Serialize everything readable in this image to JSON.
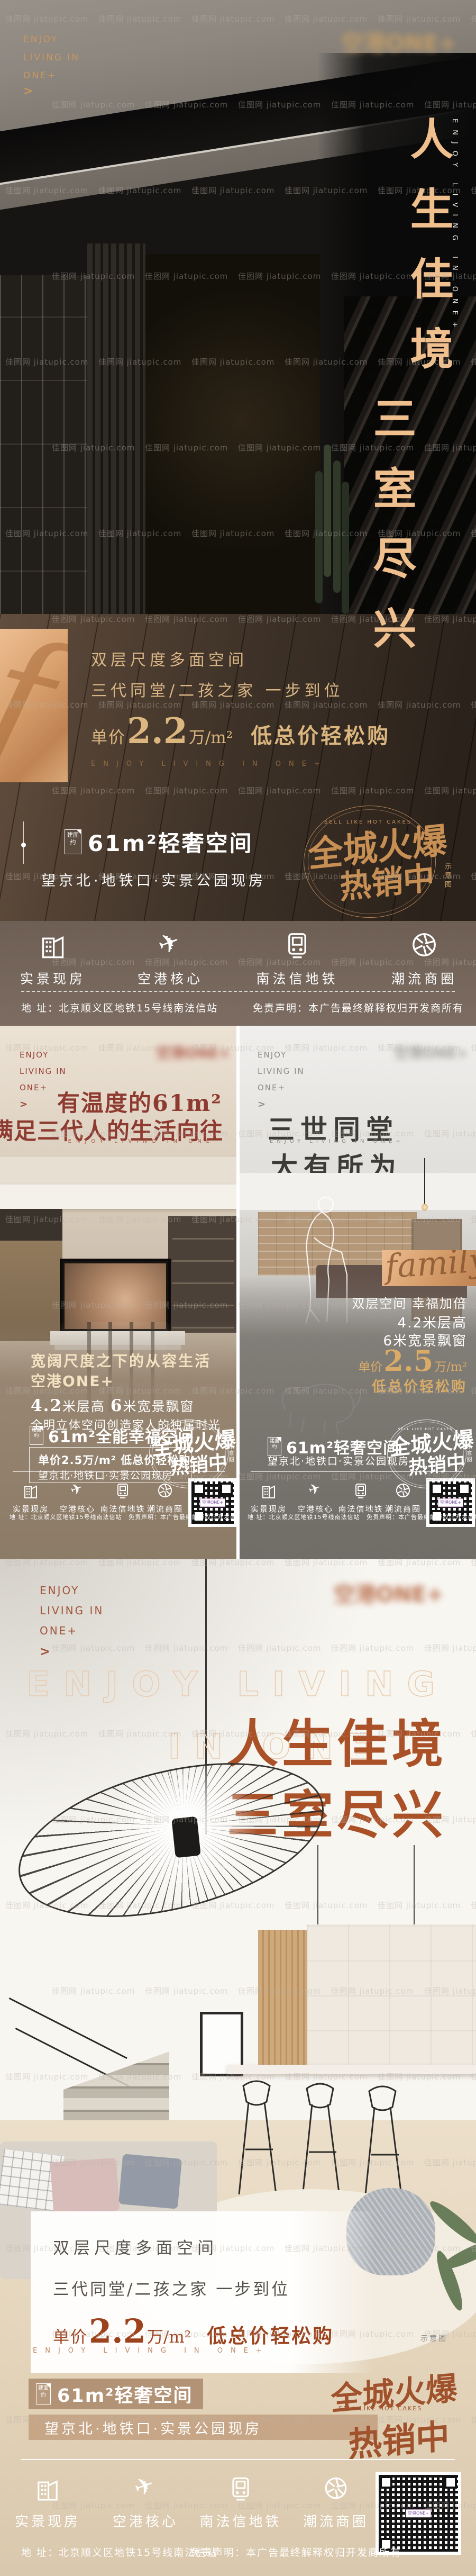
{
  "watermark": {
    "text": "佳图网 jiatupic.com"
  },
  "shared": {
    "brand": {
      "line1": "ENJOY",
      "line2": "LIVING IN",
      "line3": "ONE+",
      "arrow": ">"
    },
    "logo_text": "空港ONE+",
    "features": [
      {
        "icon": "building-icon",
        "label": "实景现房"
      },
      {
        "icon": "plane-icon",
        "glyph": "✈",
        "label": "空港核心"
      },
      {
        "icon": "train-icon",
        "label": "南法信地铁"
      },
      {
        "icon": "aperture-icon",
        "label": "潮流商圈"
      }
    ],
    "address": "地 址：北京顺义区地铁15号线南法信站",
    "disclaimer": "免责声明：本广告最终解释权归开发商所有",
    "stamp": {
      "en": "SELL LIKE HOT CAKES",
      "line1": "全城火爆",
      "line2": "热销中"
    },
    "note": "示意图",
    "qr_label": "空港ONE+"
  },
  "poster1": {
    "title_vertical_1": "人生佳境",
    "title_vertical_2": "三室尽兴",
    "title_en_vertical": "ENJOY LIVING IN ONE+",
    "sub1": "双层尺度多面空间",
    "sub2": "三代同堂/二孩之家 一步到位",
    "price": {
      "prefix": "单价",
      "value": "2.2",
      "unit": "万/m²",
      "suffix": "低总价轻松购"
    },
    "en_spaced": "ENJOY LIVING IN ONE+",
    "area_badge": "建面约",
    "area_line": "61m²轻奢空间",
    "location_line": "望京北·地铁口·实景公园现房"
  },
  "poster2_left": {
    "headline1": "有温度的61m²",
    "headline2": "满足三代人的生活向往",
    "en_spaced": "ENJOY LIVING IN ONE",
    "sub1": "宽阔尺度之下的从容生活",
    "sub2": "空港ONE+",
    "sub3_a": "4.2",
    "sub3_b": "米层高 ",
    "sub3_c": "6",
    "sub3_d": "米宽景飘窗",
    "sub4": "全明立体空间创造家人的独属时光",
    "area_badge": "建面约",
    "area_line": "61m²全能幸福空间",
    "box_line1": "单价2.5万/m² 低总价轻松购",
    "box_line2": "望京北·地铁口·实景公园现房"
  },
  "poster2_right": {
    "headline1": "三世同堂",
    "en_spaced": "ENJOY LIVING IN ONE+",
    "headline2": "大有所为",
    "script_text": "family",
    "r1": "双层空间 幸福加倍",
    "r2": "4.2米层高",
    "r3": "6米宽景飘窗",
    "price": {
      "prefix": "单价",
      "value": "2.5",
      "unit": "万/m²"
    },
    "price_suffix": "低总价轻松购",
    "area_badge": "建面约",
    "area_line": "61m²轻奢空间",
    "location_line": "望京北·地铁口·实景公园现房"
  },
  "poster3": {
    "outline_line1": "ENJOY LIVING",
    "outline_line2": "IN ONE",
    "headline1": "人生佳境",
    "headline2": "三室尽兴",
    "card_line1": "双层尺度多面空间",
    "card_line2": "三代同堂/二孩之家 一步到位",
    "price": {
      "prefix": "单价",
      "value": "2.2",
      "unit": "万/m²",
      "suffix": "低总价轻松购"
    },
    "en_spaced": "ENJOY LIVING IN ONE+",
    "area_badge": "建面约",
    "area_line": "61m²轻奢空间",
    "location_line": "望京北·地铁口·实景公园现房"
  }
}
